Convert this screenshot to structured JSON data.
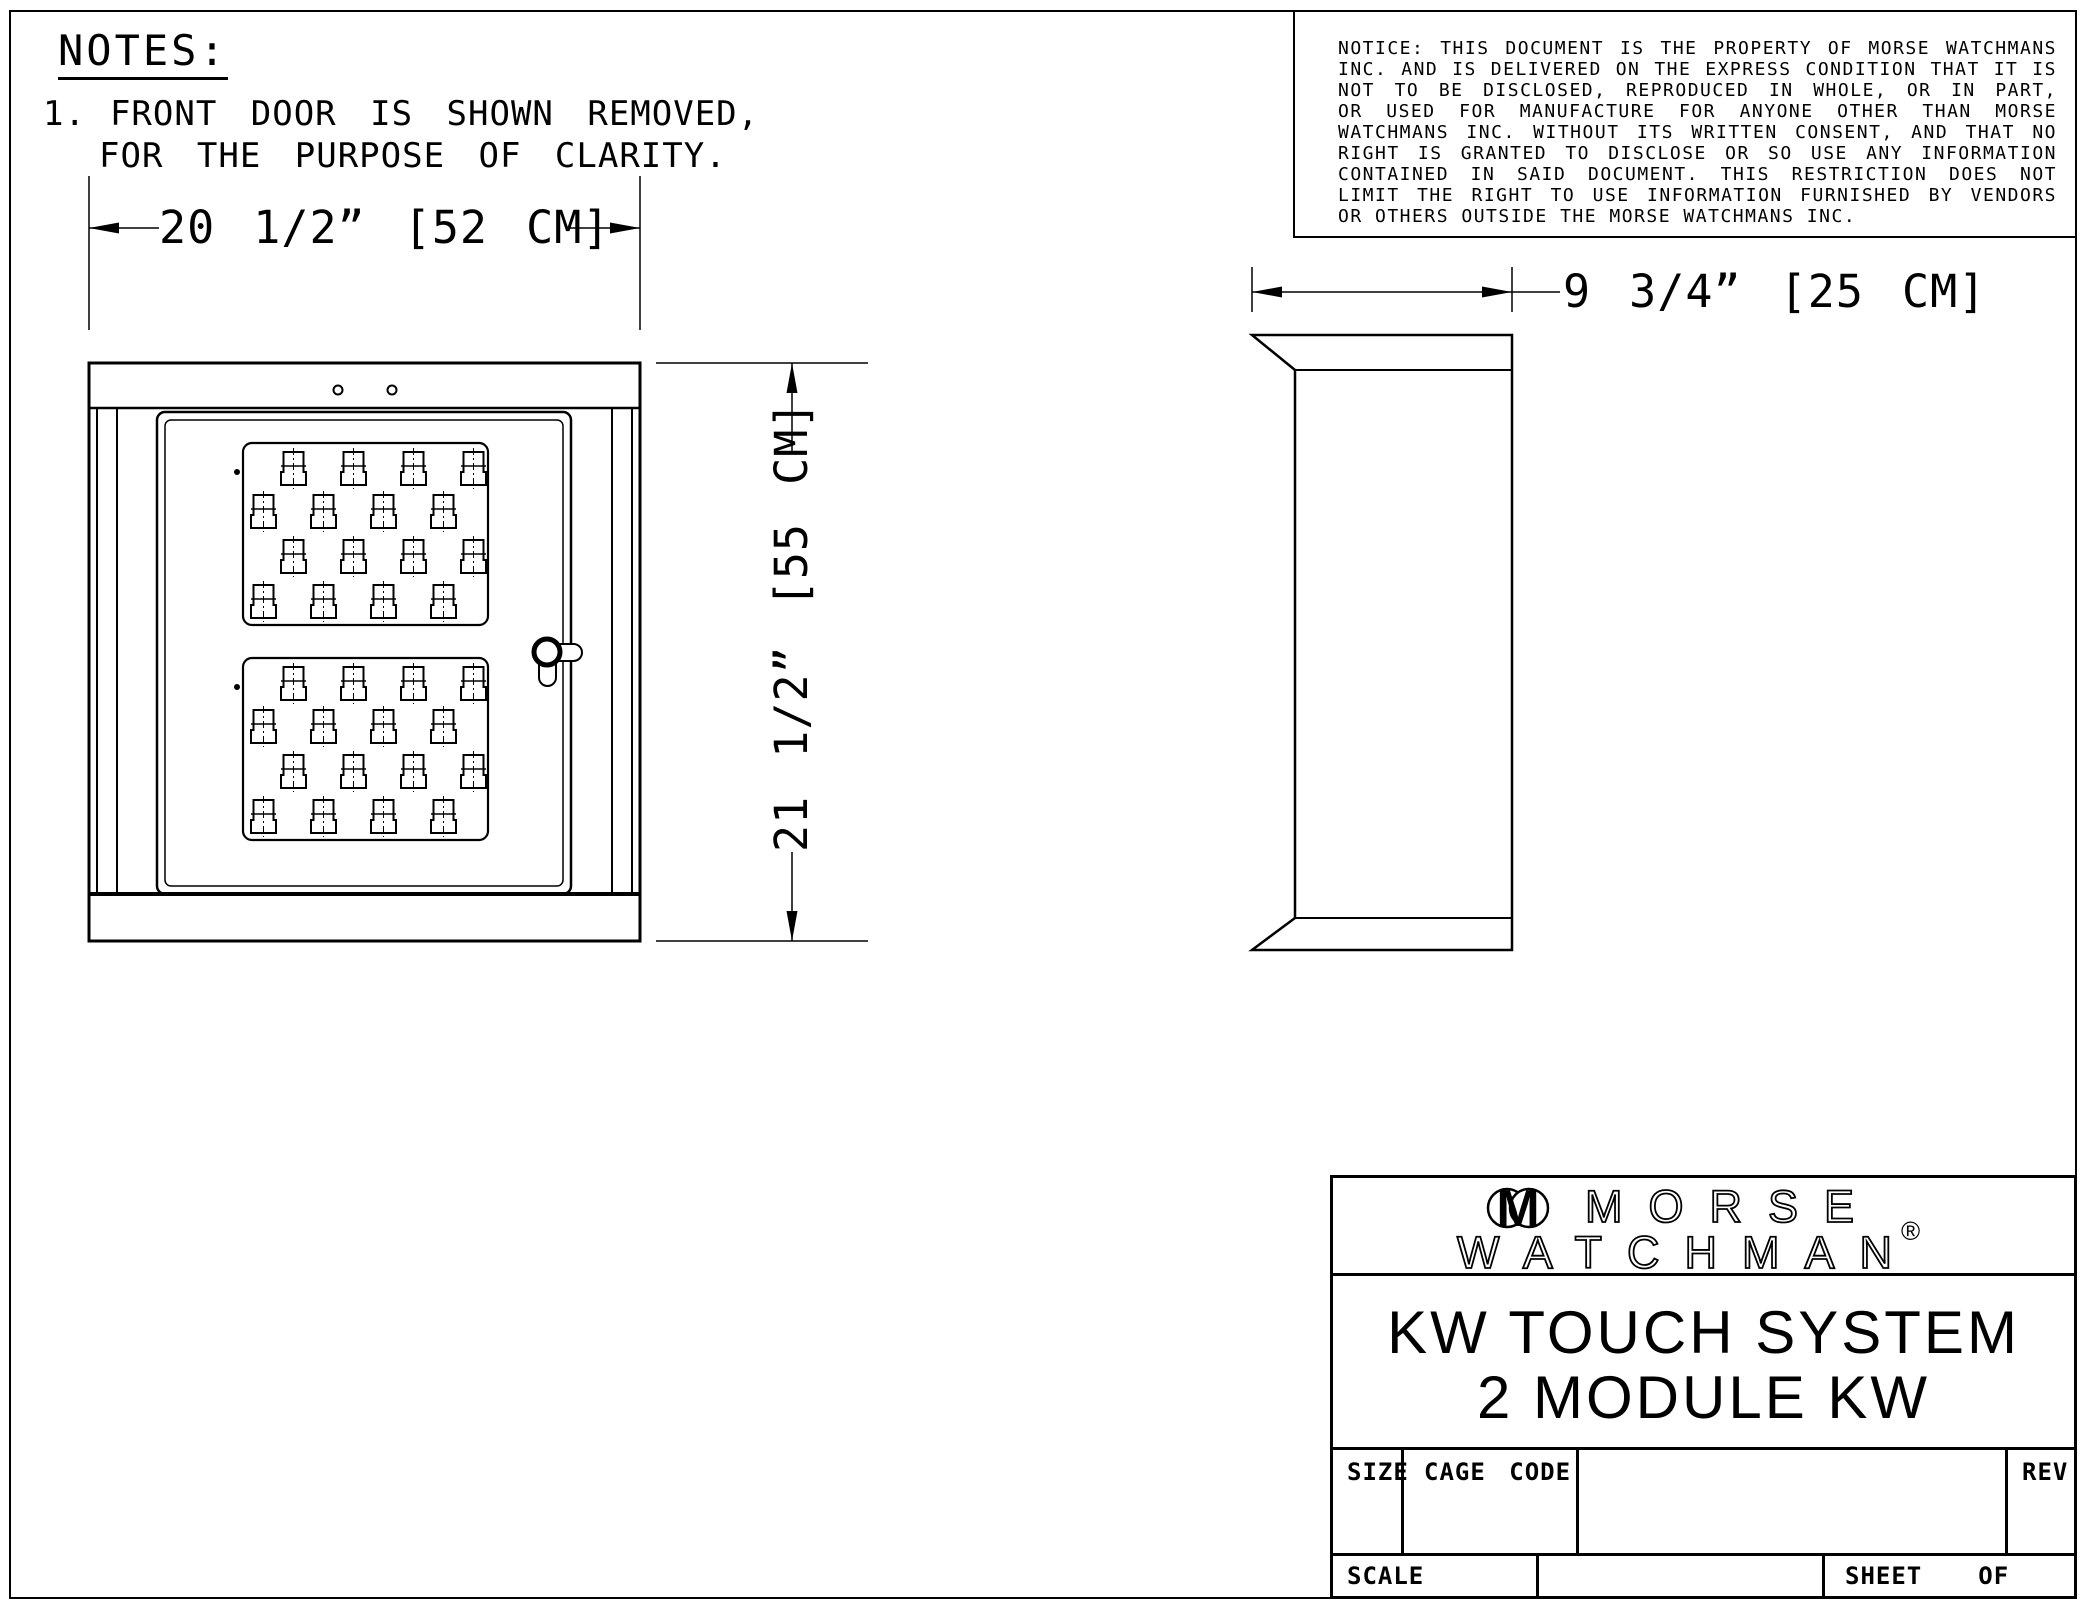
{
  "notes": {
    "heading": "NOTES:",
    "item_number": "1.",
    "item_line1": "FRONT DOOR IS SHOWN REMOVED,",
    "item_line2": "FOR THE PURPOSE OF CLARITY."
  },
  "notice": {
    "lines": [
      "NOTICE: THIS DOCUMENT IS THE PROPERTY OF MORSE WATCHMANS",
      "INC. AND IS DELIVERED ON THE EXPRESS CONDITION THAT IT IS",
      "NOT TO BE DISCLOSED, REPRODUCED IN WHOLE, OR IN PART,",
      "OR USED FOR MANUFACTURE FOR ANYONE OTHER THAN MORSE",
      "WATCHMANS INC. WITHOUT ITS WRITTEN CONSENT, AND THAT NO",
      "RIGHT IS GRANTED TO DISCLOSE OR SO USE ANY INFORMATION",
      "CONTAINED IN SAID DOCUMENT. THIS RESTRICTION DOES NOT",
      "LIMIT THE RIGHT TO USE INFORMATION FURNISHED BY VENDORS",
      "OR OTHERS OUTSIDE THE MORSE WATCHMANS INC."
    ]
  },
  "dimensions": {
    "front_width": "20 1/2” [52 CM]",
    "front_height": "21 1/2” [55 CM]",
    "side_depth": "9 3/4” [25 CM]"
  },
  "title_block": {
    "logo_letter": "M",
    "brand_line1": "MORSE",
    "brand_line2": "WATCHMAN",
    "registered_mark": "®",
    "product_line1": "KW TOUCH SYSTEM",
    "product_line2": "2 MODULE KW",
    "size_label": "SIZE",
    "cage_code_label": "CAGE CODE",
    "rev_label": "REV",
    "scale_label": "SCALE",
    "sheet_label": "SHEET",
    "of_label": "OF"
  }
}
